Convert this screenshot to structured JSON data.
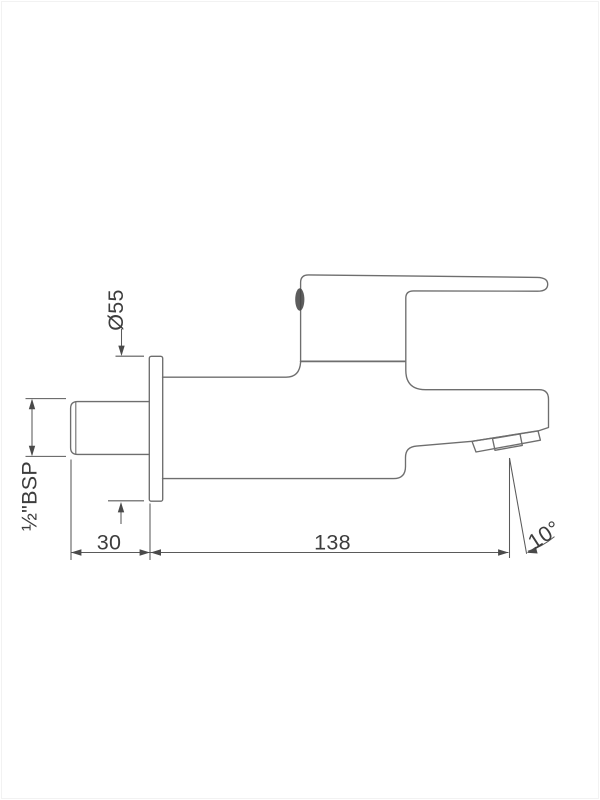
{
  "dimensions": {
    "flange_diameter": "Ø55",
    "inlet_thread": "½\"BSP",
    "wall_projection": "30",
    "body_length": "138",
    "spout_angle": "10°"
  },
  "colors": {
    "background": "#ffffff",
    "frame": "#f2f2f2",
    "line": "#6e6e6e",
    "dim_line": "#5a5a5a",
    "arrow": "#4a4a4a",
    "text": "#3d3d3d",
    "indicator_dot": "#474747"
  }
}
